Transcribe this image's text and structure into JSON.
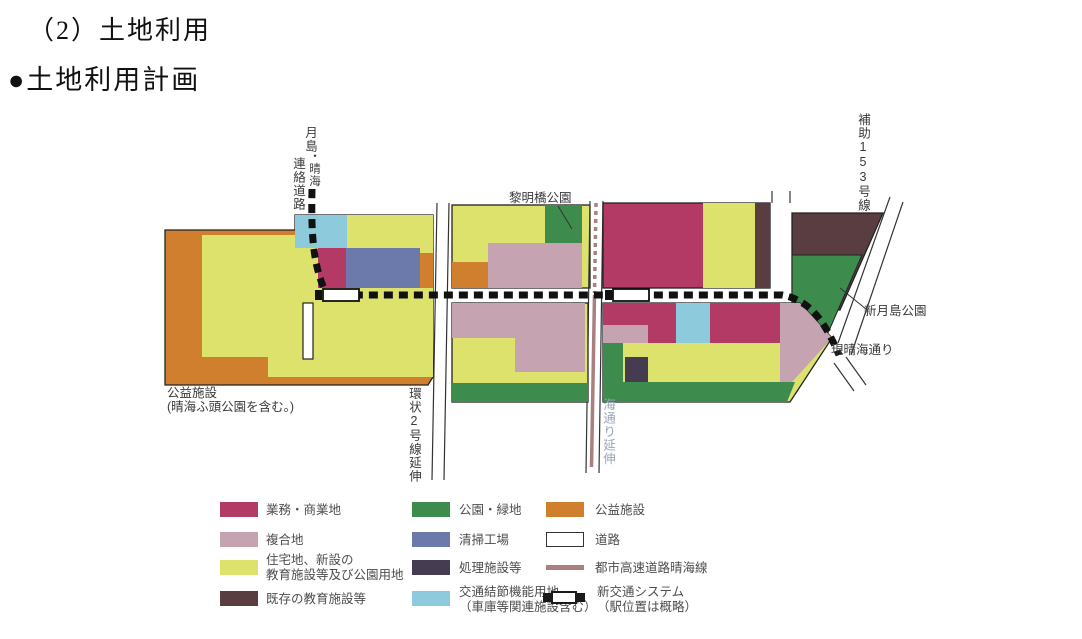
{
  "header": {
    "section_title": "（2）土地利用",
    "subsection_title": "●土地利用計画"
  },
  "colors": {
    "business": "#b43a66",
    "mixed": "#c5a3b0",
    "residential": "#dce26b",
    "existing_edu": "#5a3d41",
    "park": "#3e8b4e",
    "cleaning_plant": "#6b79ab",
    "treatment": "#453c51",
    "transport_node": "#8ccadc",
    "public_facility": "#d07f2e",
    "road_white": "#ffffff",
    "expressway": "#aa7f80",
    "outline": "#222222",
    "umidori_label": "#98a6b8"
  },
  "map": {
    "labels": {
      "tsukishima_top": "月島",
      "tsukishima_left": "連絡道路",
      "tsukishima_right": "・晴海",
      "reimeibashi_park": "黎明橋公園",
      "hojo153": "補助153号線",
      "shin_tsukishima_park": "新月島公園",
      "gen_harumi_dori": "現晴海通り",
      "koeki_line1": "公益施設",
      "koeki_line2": "(晴海ふ頭公園を含む。)",
      "kanjo2_extension": "環状2号線延伸",
      "harumi_dori_extension": "海通り延伸"
    }
  },
  "legend": {
    "items": [
      {
        "key": "business",
        "label": "業務・商業地"
      },
      {
        "key": "mixed",
        "label": "複合地"
      },
      {
        "key": "residential",
        "label": "住宅地、新設の",
        "label2": "教育施設等及び公園用地"
      },
      {
        "key": "existing_edu",
        "label": "既存の教育施設等"
      },
      {
        "key": "park",
        "label": "公園・緑地"
      },
      {
        "key": "cleaning_plant",
        "label": "清掃工場"
      },
      {
        "key": "treatment",
        "label": "処理施設等"
      },
      {
        "key": "transport_node",
        "label": "交通結節機能用地",
        "label2": "（車庫等関連施設含む）"
      },
      {
        "key": "public_facility",
        "label": "公益施設"
      },
      {
        "key": "road",
        "label": "道路"
      },
      {
        "key": "expressway",
        "label": "都市高速道路晴海線"
      },
      {
        "key": "new_transit",
        "label": "新交通システム",
        "label2": "（駅位置は概略）"
      }
    ]
  }
}
